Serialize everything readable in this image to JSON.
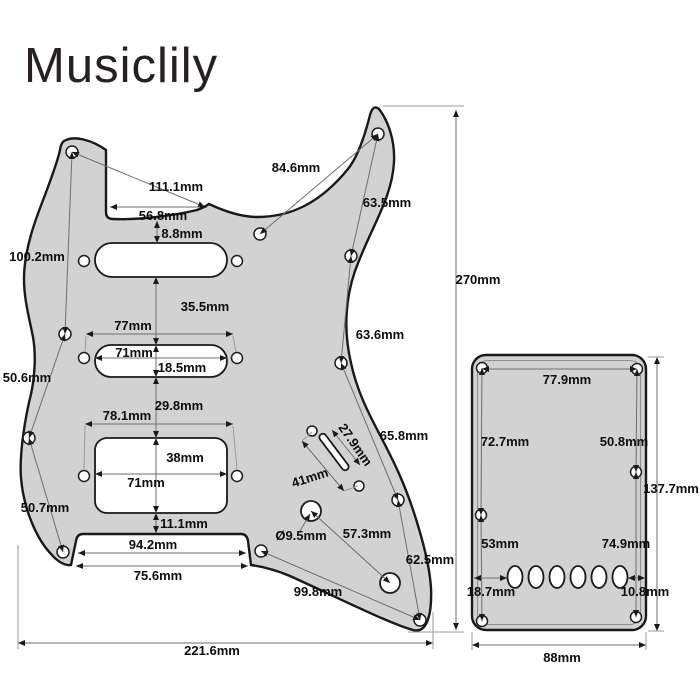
{
  "brand": {
    "logo": "Musiclily"
  },
  "colors": {
    "pickguard_fill": "#d2d2d2",
    "outline": "#191919",
    "dimension_line": "#6e6e6e",
    "label_text": "#0d0d0d",
    "background": "#ffffff"
  },
  "pickguard": {
    "description": "HSS strat-style pickguard dimension drawing",
    "dims": {
      "d111": "111.1mm",
      "d56": "56.8mm",
      "d8": "8.8mm",
      "d84": "84.6mm",
      "d63a": "63.5mm",
      "d63b": "63.6mm",
      "d65": "65.8mm",
      "d62": "62.5mm",
      "d100": "100.2mm",
      "d50a": "50.6mm",
      "d50b": "50.7mm",
      "d99": "99.8mm",
      "d57": "57.3mm",
      "d95": "Ø9.5mm",
      "d41": "41mm",
      "d279": "27.9mm",
      "d35": "35.5mm",
      "d77": "77mm",
      "d71m": "71mm",
      "d185": "18.5mm",
      "d29": "29.8mm",
      "d781": "78.1mm",
      "d38": "38mm",
      "d71h": "71mm",
      "d11": "11.1mm",
      "d94": "94.2mm",
      "d75": "75.6mm",
      "d221": "221.6mm",
      "d270": "270mm"
    }
  },
  "backplate": {
    "description": "Tremolo back cover plate dimension drawing",
    "dims": {
      "b779": "77.9mm",
      "b727": "72.7mm",
      "b508": "50.8mm",
      "b53": "53mm",
      "b749": "74.9mm",
      "b187": "18.7mm",
      "b108": "10.8mm",
      "b1377": "137.7mm",
      "b88": "88mm"
    }
  }
}
